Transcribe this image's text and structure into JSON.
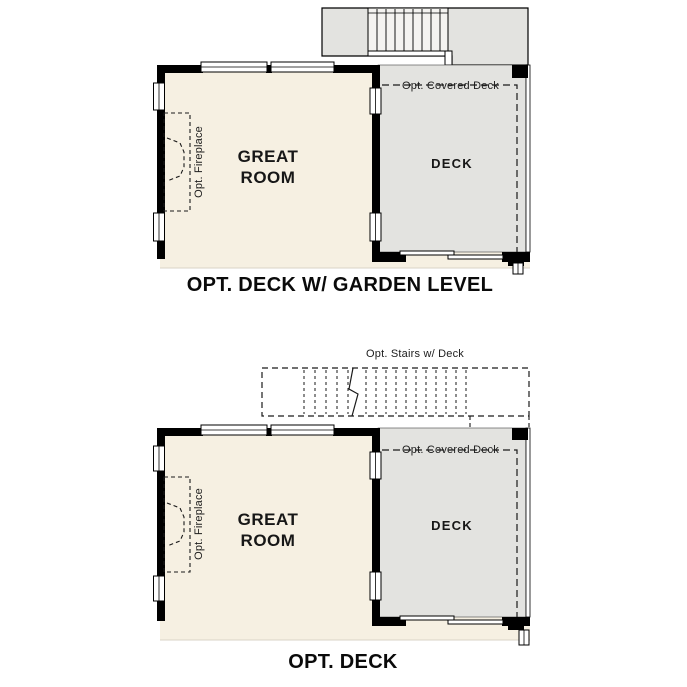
{
  "diagram_title": "Great Room Deck Options Floor Plans",
  "colors": {
    "floor_cream": "#f6f0e2",
    "deck_gray": "#e3e3e0",
    "stair_tread_fill": "#f4f3f0",
    "wall_black": "#000000",
    "background": "#ffffff"
  },
  "plans": [
    {
      "caption": "OPT. DECK W/ GARDEN LEVEL",
      "labels": {
        "great_room": "GREAT ROOM",
        "deck": "DECK",
        "covered_deck": "Opt. Covered Deck",
        "fireplace": "Opt. Fireplace"
      }
    },
    {
      "caption": "OPT. DECK",
      "labels": {
        "great_room": "GREAT ROOM",
        "deck": "DECK",
        "covered_deck": "Opt. Covered Deck",
        "fireplace": "Opt. Fireplace",
        "stairs": "Opt. Stairs w/ Deck"
      }
    }
  ]
}
